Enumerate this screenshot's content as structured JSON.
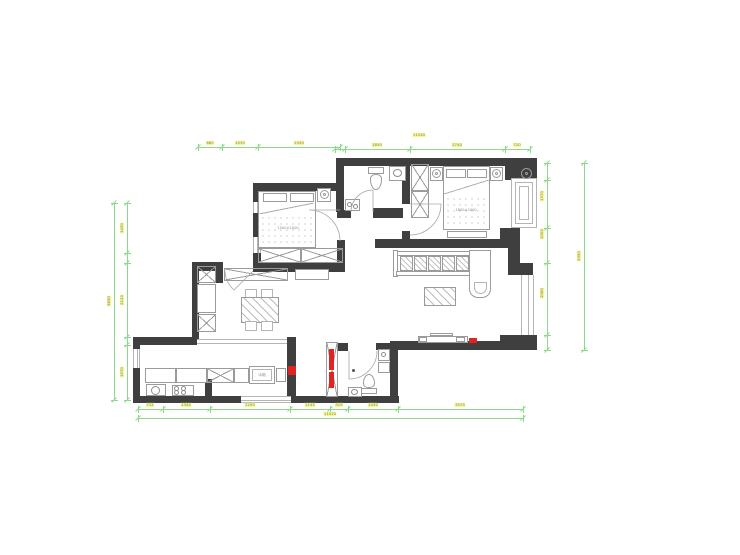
{
  "colors": {
    "wall": "#3f3f3f",
    "furniture_line": "#9b9b9b",
    "dimension_green": "#8cd88c",
    "dim_label_bg": "#f4f4a4",
    "dim_label_text": "#8a8a30",
    "highlight_red": "#e02424"
  },
  "labels": {
    "master_bed_size": "1800×2000",
    "second_bed_size": "1500×2000",
    "fridge": "冰箱"
  },
  "dimensions": {
    "rows": [
      {
        "id": "top-a",
        "orient": "h",
        "x1": 198,
        "x2": 340,
        "y": 147,
        "ticks": [
          198,
          222,
          258,
          340
        ],
        "labels": [
          {
            "p": 210,
            "t": "680"
          },
          {
            "p": 240,
            "t": "1030"
          },
          {
            "p": 299,
            "t": "2340"
          }
        ]
      },
      {
        "id": "top-b",
        "orient": "h",
        "x1": 335,
        "x2": 530,
        "y": 149,
        "ticks": [
          335,
          345,
          410,
          505,
          530
        ],
        "labels": [
          {
            "p": 377,
            "t": "1850"
          },
          {
            "p": 457,
            "t": "2740"
          },
          {
            "p": 517,
            "t": "720"
          }
        ]
      },
      {
        "id": "top-total",
        "orient": "h",
        "x1": 335,
        "x2": 530,
        "y": 139,
        "noline": true,
        "ticks": [],
        "labels": [
          {
            "p": 419,
            "t": "11540"
          }
        ]
      },
      {
        "id": "right-inner",
        "orient": "v",
        "x": 547,
        "y1": 163,
        "y2": 350,
        "ticks": [
          163,
          180,
          228,
          263,
          335,
          350
        ],
        "labels": [
          {
            "p": 196,
            "t": "1370"
          },
          {
            "p": 234,
            "t": "1000"
          },
          {
            "p": 293,
            "t": "2060"
          }
        ]
      },
      {
        "id": "right-outer",
        "orient": "v",
        "x": 584,
        "y1": 163,
        "y2": 350,
        "ticks": [
          163,
          350
        ],
        "labels": [
          {
            "p": 256,
            "t": "5350"
          }
        ]
      },
      {
        "id": "left-inner",
        "orient": "v",
        "x": 127,
        "y1": 203,
        "y2": 400,
        "ticks": [
          203,
          253,
          263,
          337,
          345,
          400
        ],
        "labels": [
          {
            "p": 228,
            "t": "1430"
          },
          {
            "p": 300,
            "t": "2120"
          },
          {
            "p": 372,
            "t": "1570"
          }
        ]
      },
      {
        "id": "left-outer",
        "orient": "v",
        "x": 114,
        "y1": 203,
        "y2": 400,
        "ticks": [
          203,
          400
        ],
        "labels": [
          {
            "p": 301,
            "t": "5630"
          }
        ]
      },
      {
        "id": "bottom-a",
        "orient": "h",
        "x1": 138,
        "x2": 523,
        "y": 409,
        "ticks": [
          138,
          163,
          210,
          290,
          330,
          348,
          398,
          523
        ],
        "labels": [
          {
            "p": 150,
            "t": "715"
          },
          {
            "p": 186,
            "t": "1340"
          },
          {
            "p": 250,
            "t": "2290"
          },
          {
            "p": 310,
            "t": "1145"
          },
          {
            "p": 339,
            "t": "515"
          },
          {
            "p": 373,
            "t": "1430"
          },
          {
            "p": 460,
            "t": "3575"
          }
        ]
      },
      {
        "id": "bottom-total",
        "orient": "h",
        "x1": 138,
        "x2": 523,
        "y": 418,
        "ticks": [
          138,
          523
        ],
        "labels": [
          {
            "p": 330,
            "t": "11020"
          }
        ]
      }
    ]
  }
}
